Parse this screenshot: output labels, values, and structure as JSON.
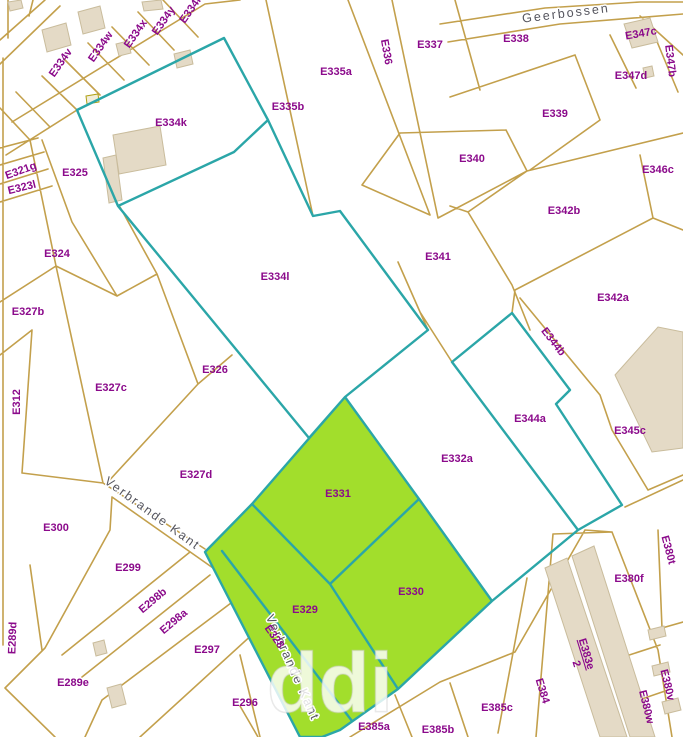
{
  "map": {
    "watermark": "ddi",
    "colors": {
      "background": "#ffffff",
      "parcel_line": "#C3A04C",
      "selection_line": "#2BA6A8",
      "selected_fill": "#A2DE2C",
      "building_fill": "#E4DAC6",
      "building_stroke": "#C9BC9C",
      "parcel_label": "#8B0A8B",
      "street_label": "#55555e"
    },
    "street_labels": [
      {
        "id": "geerbossen",
        "text": "Geerbossen",
        "x": 566,
        "y": 14,
        "rotation": -7
      },
      {
        "id": "verbrande-kant",
        "text": "Verbrande Kant",
        "x": 152,
        "y": 514,
        "rotation": 36
      },
      {
        "id": "verbrande-kant-south",
        "text": "Verbrande Kant",
        "x": 292,
        "y": 668,
        "rotation": 66
      }
    ],
    "parcel_labels": [
      {
        "text": "E334v",
        "x": 61,
        "y": 63,
        "rot": -55
      },
      {
        "text": "E334w",
        "x": 101,
        "y": 47,
        "rot": -55
      },
      {
        "text": "E334x",
        "x": 136,
        "y": 34,
        "rot": -55
      },
      {
        "text": "E334y",
        "x": 164,
        "y": 21,
        "rot": -55
      },
      {
        "text": "E334r",
        "x": 191,
        "y": 10,
        "rot": -55
      },
      {
        "text": "E334k",
        "x": 171,
        "y": 123,
        "rot": 0
      },
      {
        "text": "E335b",
        "x": 288,
        "y": 107,
        "rot": 0
      },
      {
        "text": "E335a",
        "x": 336,
        "y": 72,
        "rot": 0
      },
      {
        "text": "E336",
        "x": 386,
        "y": 52,
        "rot": 80
      },
      {
        "text": "E337",
        "x": 430,
        "y": 45,
        "rot": 0
      },
      {
        "text": "E338",
        "x": 516,
        "y": 39,
        "rot": 0
      },
      {
        "text": "E347c",
        "x": 641,
        "y": 34,
        "rot": -10
      },
      {
        "text": "E347b",
        "x": 670,
        "y": 61,
        "rot": 83
      },
      {
        "text": "E347d",
        "x": 631,
        "y": 76,
        "rot": 0
      },
      {
        "text": "E339",
        "x": 555,
        "y": 114,
        "rot": 0
      },
      {
        "text": "E340",
        "x": 472,
        "y": 159,
        "rot": 0
      },
      {
        "text": "E346c",
        "x": 658,
        "y": 170,
        "rot": 0
      },
      {
        "text": "E342b",
        "x": 564,
        "y": 211,
        "rot": 0
      },
      {
        "text": "E342a",
        "x": 613,
        "y": 298,
        "rot": 0
      },
      {
        "text": "E341",
        "x": 438,
        "y": 257,
        "rot": 0
      },
      {
        "text": "E321g",
        "x": 21,
        "y": 171,
        "rot": -20
      },
      {
        "text": "E323l",
        "x": 22,
        "y": 188,
        "rot": -14
      },
      {
        "text": "E325",
        "x": 75,
        "y": 173,
        "rot": 0
      },
      {
        "text": "E324",
        "x": 57,
        "y": 254,
        "rot": 0
      },
      {
        "text": "E327b",
        "x": 28,
        "y": 312,
        "rot": 0
      },
      {
        "text": "E334l",
        "x": 275,
        "y": 277,
        "rot": 0
      },
      {
        "text": "E326",
        "x": 215,
        "y": 370,
        "rot": 0
      },
      {
        "text": "E327c",
        "x": 111,
        "y": 388,
        "rot": 0
      },
      {
        "text": "E312",
        "x": 17,
        "y": 402,
        "rot": -90
      },
      {
        "text": "E344b",
        "x": 553,
        "y": 342,
        "rot": 52
      },
      {
        "text": "E344a",
        "x": 530,
        "y": 419,
        "rot": 0
      },
      {
        "text": "E345c",
        "x": 630,
        "y": 431,
        "rot": 0
      },
      {
        "text": "E332a",
        "x": 457,
        "y": 459,
        "rot": 0
      },
      {
        "text": "E327d",
        "x": 196,
        "y": 475,
        "rot": 0
      },
      {
        "text": "E331",
        "x": 338,
        "y": 494,
        "rot": 0
      },
      {
        "text": "E300",
        "x": 56,
        "y": 528,
        "rot": 0
      },
      {
        "text": "E299",
        "x": 128,
        "y": 568,
        "rot": 0
      },
      {
        "text": "E298b",
        "x": 153,
        "y": 601,
        "rot": -40
      },
      {
        "text": "E298a",
        "x": 174,
        "y": 622,
        "rot": -40
      },
      {
        "text": "E289d",
        "x": 13,
        "y": 638,
        "rot": -88
      },
      {
        "text": "E297",
        "x": 207,
        "y": 650,
        "rot": 0
      },
      {
        "text": "E289e",
        "x": 73,
        "y": 683,
        "rot": 0
      },
      {
        "text": "E296",
        "x": 245,
        "y": 703,
        "rot": 0
      },
      {
        "text": "E329",
        "x": 305,
        "y": 610,
        "rot": 0
      },
      {
        "text": "E330",
        "x": 411,
        "y": 592,
        "rot": 0
      },
      {
        "text": "E328",
        "x": 274,
        "y": 637,
        "rot": 55
      },
      {
        "text": "E385a",
        "x": 374,
        "y": 727,
        "rot": 0
      },
      {
        "text": "E385b",
        "x": 438,
        "y": 730,
        "rot": 0
      },
      {
        "text": "E385c",
        "x": 497,
        "y": 708,
        "rot": 0
      },
      {
        "text": "E384",
        "x": 542,
        "y": 691,
        "rot": 73
      },
      {
        "text": "E383e",
        "x": 586,
        "y": 654,
        "rot": 73,
        "underline": true
      },
      {
        "text": "2",
        "x": 576,
        "y": 664,
        "rot": 73
      },
      {
        "text": "E380f",
        "x": 629,
        "y": 579,
        "rot": 0
      },
      {
        "text": "E380t",
        "x": 668,
        "y": 550,
        "rot": 75
      },
      {
        "text": "E380v",
        "x": 667,
        "y": 685,
        "rot": 76
      },
      {
        "text": "E380w",
        "x": 646,
        "y": 707,
        "rot": 76
      }
    ]
  }
}
